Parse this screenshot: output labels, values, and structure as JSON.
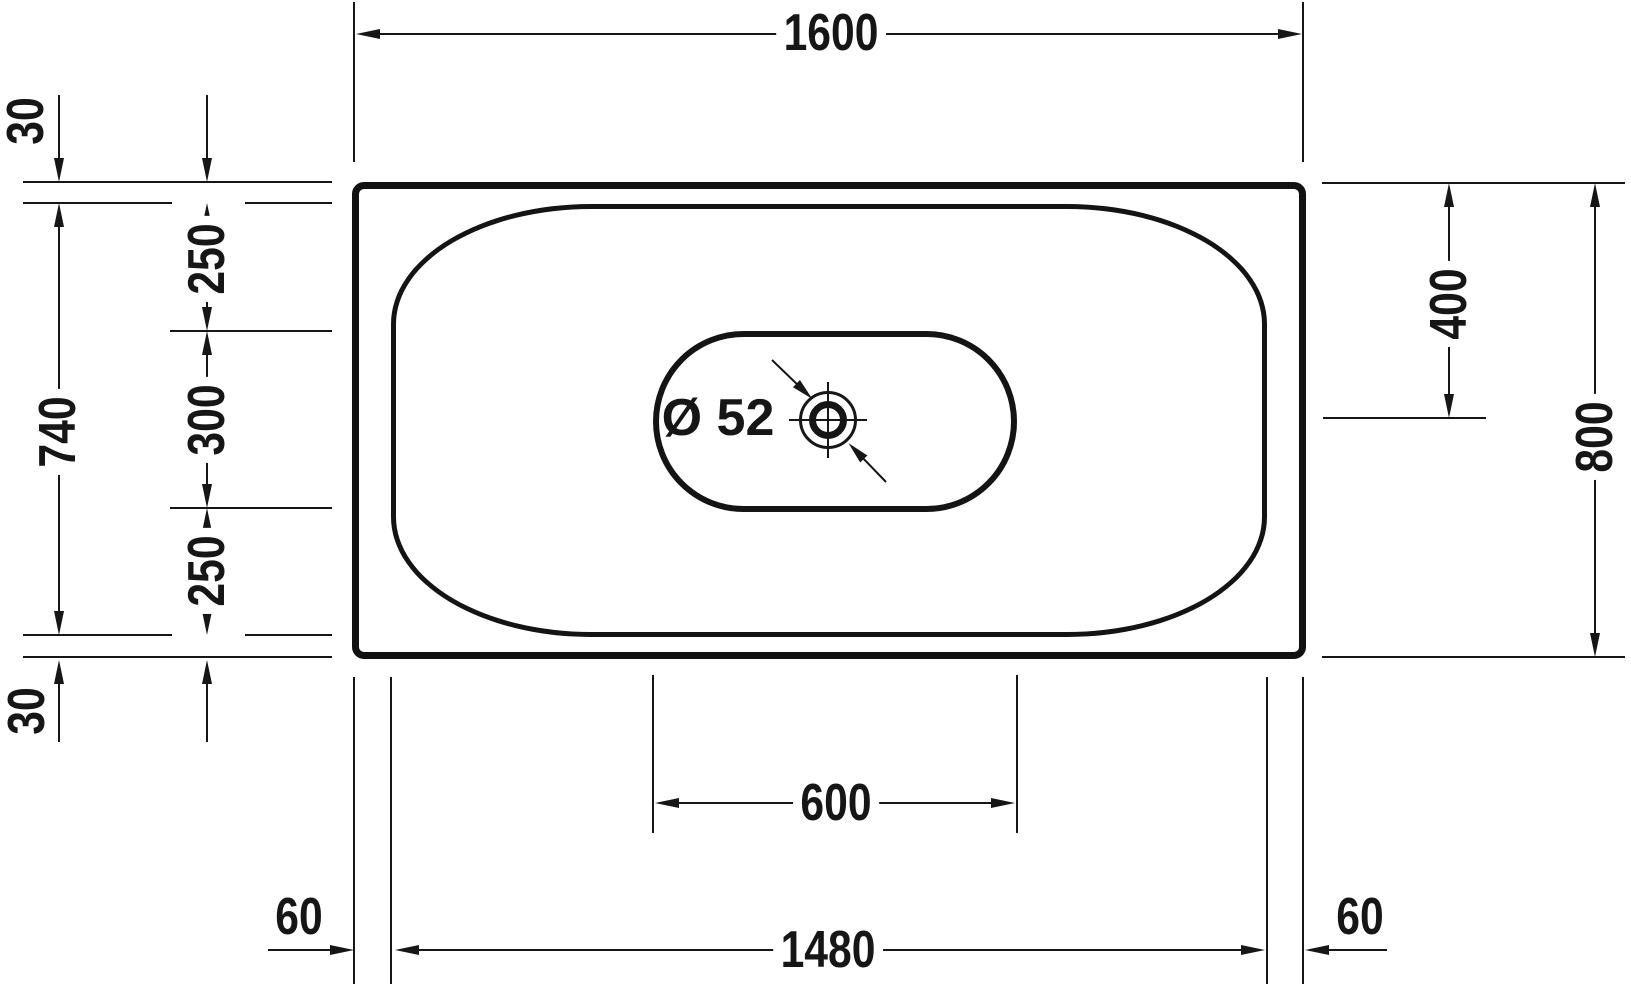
{
  "title": "Bathtub technical drawing - top view",
  "dimensions": {
    "overall_length": "1600",
    "overall_width": "800",
    "rim_offset_top": "30",
    "rim_offset_bottom": "30",
    "basin_width": "740",
    "basin_top_segment": "250",
    "drain_zone_width": "300",
    "basin_bottom_segment": "250",
    "center_line_offset": "400",
    "drain_zone_length": "600",
    "basin_length": "1480",
    "rim_offset_left": "60",
    "rim_offset_right": "60",
    "drain_diameter": "Ø 52"
  }
}
